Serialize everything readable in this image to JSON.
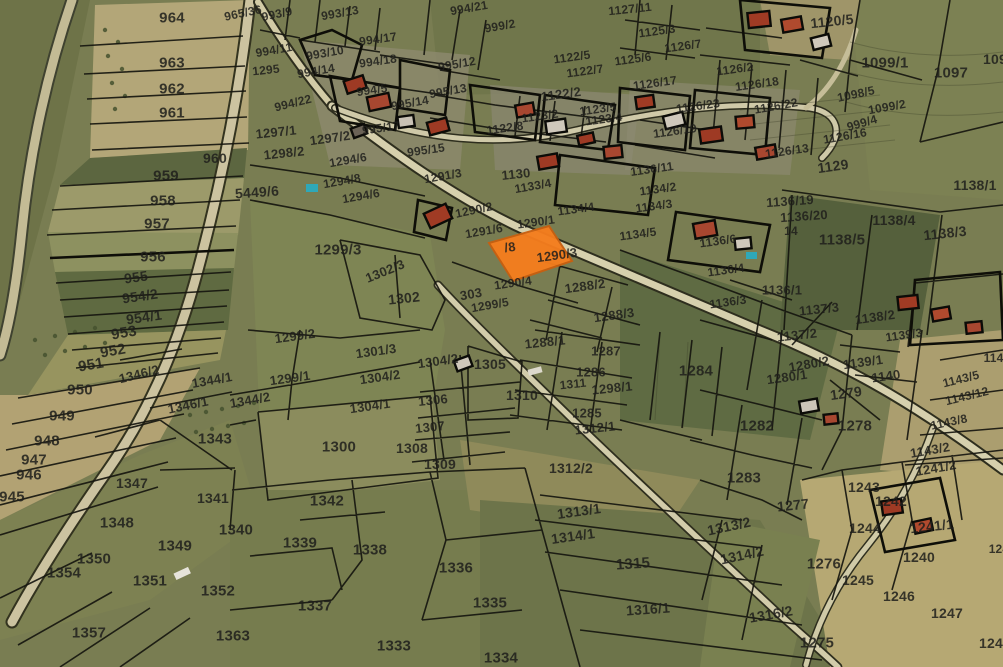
{
  "map": {
    "kind": "cadastral-parcel-map-over-aerial-imagery",
    "highlighted_parcel": {
      "visible_label": "/8",
      "overlapping_neighbor_label": "1290/3",
      "fill_color": "#f57d1d",
      "stroke_color": "#c85f10"
    },
    "colors": {
      "parcel_line": "#16160f",
      "label": "#1f1f1c",
      "road_fill": "#d2cba6",
      "field_green": "#797d52",
      "field_tan": "#b3a678"
    },
    "parcel_labels": [
      {
        "t": "964",
        "x": 172,
        "y": 18,
        "s": 15
      },
      {
        "t": "963",
        "x": 172,
        "y": 63,
        "s": 15
      },
      {
        "t": "962",
        "x": 172,
        "y": 89,
        "s": 15
      },
      {
        "t": "961",
        "x": 172,
        "y": 113,
        "s": 15
      },
      {
        "t": "960",
        "x": 215,
        "y": 158,
        "s": 14
      },
      {
        "t": "959",
        "x": 166,
        "y": 176,
        "s": 15
      },
      {
        "t": "958",
        "x": 163,
        "y": 201,
        "s": 15
      },
      {
        "t": "957",
        "x": 157,
        "y": 224,
        "s": 15
      },
      {
        "t": "956",
        "x": 153,
        "y": 257,
        "s": 15
      },
      {
        "t": "955",
        "x": 136,
        "y": 277,
        "s": 14,
        "r": -8
      },
      {
        "t": "954/2",
        "x": 140,
        "y": 296,
        "s": 14,
        "r": -8
      },
      {
        "t": "954/1",
        "x": 144,
        "y": 317,
        "s": 14,
        "r": -8
      },
      {
        "t": "953",
        "x": 124,
        "y": 333,
        "s": 15,
        "r": -10
      },
      {
        "t": "952",
        "x": 113,
        "y": 351,
        "s": 15,
        "r": -10
      },
      {
        "t": "951",
        "x": 91,
        "y": 365,
        "s": 15,
        "r": -10
      },
      {
        "t": "950",
        "x": 80,
        "y": 390,
        "s": 15
      },
      {
        "t": "949",
        "x": 62,
        "y": 416,
        "s": 15
      },
      {
        "t": "948",
        "x": 47,
        "y": 441,
        "s": 15
      },
      {
        "t": "947",
        "x": 34,
        "y": 460,
        "s": 15
      },
      {
        "t": "946",
        "x": 29,
        "y": 475,
        "s": 15
      },
      {
        "t": "945",
        "x": 12,
        "y": 497,
        "s": 15
      },
      {
        "t": "965/36",
        "x": 243,
        "y": 13,
        "s": 12,
        "r": -12
      },
      {
        "t": "5449/6",
        "x": 257,
        "y": 192,
        "s": 14,
        "r": -4
      },
      {
        "t": "993/9",
        "x": 277,
        "y": 14,
        "s": 12,
        "r": -12
      },
      {
        "t": "993/13",
        "x": 340,
        "y": 13,
        "s": 12,
        "r": -10
      },
      {
        "t": "994/21",
        "x": 469,
        "y": 8,
        "s": 12,
        "r": -10
      },
      {
        "t": "999/2",
        "x": 500,
        "y": 26,
        "s": 12,
        "r": -10
      },
      {
        "t": "994/17",
        "x": 378,
        "y": 39,
        "s": 12,
        "r": -8
      },
      {
        "t": "994/11",
        "x": 274,
        "y": 50,
        "s": 12,
        "r": -10
      },
      {
        "t": "993/10",
        "x": 325,
        "y": 53,
        "s": 12,
        "r": -10
      },
      {
        "t": "994/18",
        "x": 378,
        "y": 61,
        "s": 12,
        "r": -8
      },
      {
        "t": "995/12",
        "x": 457,
        "y": 64,
        "s": 12,
        "r": -10
      },
      {
        "t": "1295",
        "x": 266,
        "y": 70,
        "s": 12,
        "r": -6
      },
      {
        "t": "994/14",
        "x": 316,
        "y": 71,
        "s": 12,
        "r": -10
      },
      {
        "t": "994/5",
        "x": 372,
        "y": 90,
        "s": 12,
        "r": -8
      },
      {
        "t": "995/13",
        "x": 448,
        "y": 91,
        "s": 12,
        "r": -10
      },
      {
        "t": "995/14",
        "x": 410,
        "y": 103,
        "s": 12,
        "r": -10
      },
      {
        "t": "994/22",
        "x": 293,
        "y": 103,
        "s": 12,
        "r": -14
      },
      {
        "t": "995/17",
        "x": 381,
        "y": 128,
        "s": 12,
        "r": -8
      },
      {
        "t": "995/15",
        "x": 426,
        "y": 150,
        "s": 12,
        "r": -8
      },
      {
        "t": "1297/1",
        "x": 276,
        "y": 132,
        "s": 13,
        "r": -6
      },
      {
        "t": "1297/2",
        "x": 330,
        "y": 138,
        "s": 13,
        "r": -8
      },
      {
        "t": "1298/2",
        "x": 284,
        "y": 153,
        "s": 13,
        "r": -6
      },
      {
        "t": "1294/6",
        "x": 348,
        "y": 160,
        "s": 12,
        "r": -10
      },
      {
        "t": "1294/8",
        "x": 342,
        "y": 181,
        "s": 12,
        "r": -10
      },
      {
        "t": "1294/6",
        "x": 361,
        "y": 196,
        "s": 12,
        "r": -10
      },
      {
        "t": "1291/3",
        "x": 443,
        "y": 176,
        "s": 12,
        "r": -10
      },
      {
        "t": "1122/5",
        "x": 572,
        "y": 57,
        "s": 12,
        "r": -8
      },
      {
        "t": "1122/7",
        "x": 585,
        "y": 71,
        "s": 12,
        "r": -8
      },
      {
        "t": "1122/2",
        "x": 561,
        "y": 94,
        "s": 13,
        "r": -8
      },
      {
        "t": "1123/5",
        "x": 598,
        "y": 109,
        "s": 12,
        "r": -8
      },
      {
        "t": "1123/2",
        "x": 540,
        "y": 116,
        "s": 12,
        "r": -8
      },
      {
        "t": "1123/4",
        "x": 604,
        "y": 119,
        "s": 12,
        "r": -8
      },
      {
        "t": "1122/8",
        "x": 505,
        "y": 128,
        "s": 12,
        "r": -8
      },
      {
        "t": "1130",
        "x": 516,
        "y": 174,
        "s": 13,
        "r": -6
      },
      {
        "t": "1133/4",
        "x": 533,
        "y": 186,
        "s": 12,
        "r": -10
      },
      {
        "t": "1127/11",
        "x": 630,
        "y": 9,
        "s": 12,
        "r": -6
      },
      {
        "t": "1125/3",
        "x": 657,
        "y": 31,
        "s": 12,
        "r": -8
      },
      {
        "t": "1126/7",
        "x": 683,
        "y": 46,
        "s": 12,
        "r": -8
      },
      {
        "t": "1125/6",
        "x": 633,
        "y": 59,
        "s": 12,
        "r": -8
      },
      {
        "t": "1126/2",
        "x": 735,
        "y": 69,
        "s": 12,
        "r": -8
      },
      {
        "t": "1126/17",
        "x": 655,
        "y": 83,
        "s": 12,
        "r": -8
      },
      {
        "t": "1126/18",
        "x": 757,
        "y": 84,
        "s": 12,
        "r": -8
      },
      {
        "t": "1126/23",
        "x": 698,
        "y": 106,
        "s": 12,
        "r": -8
      },
      {
        "t": "1126/22",
        "x": 776,
        "y": 106,
        "s": 12,
        "r": -10
      },
      {
        "t": "1126/19",
        "x": 675,
        "y": 131,
        "s": 12,
        "r": -8
      },
      {
        "t": "1126/13",
        "x": 787,
        "y": 151,
        "s": 12,
        "r": -8
      },
      {
        "t": "1126/16",
        "x": 845,
        "y": 136,
        "s": 12,
        "r": -10
      },
      {
        "t": "999/4",
        "x": 862,
        "y": 123,
        "s": 12,
        "r": -16
      },
      {
        "t": "1098/5",
        "x": 856,
        "y": 94,
        "s": 12,
        "r": -12
      },
      {
        "t": "1099/2",
        "x": 887,
        "y": 107,
        "s": 12,
        "r": -10
      },
      {
        "t": "1120/5",
        "x": 832,
        "y": 21,
        "s": 14,
        "r": -6
      },
      {
        "t": "1099/1",
        "x": 885,
        "y": 63,
        "s": 15
      },
      {
        "t": "1097",
        "x": 951,
        "y": 73,
        "s": 15
      },
      {
        "t": "109",
        "x": 995,
        "y": 59,
        "s": 14
      },
      {
        "t": "1129",
        "x": 833,
        "y": 166,
        "s": 14,
        "r": -8
      },
      {
        "t": "1136/11",
        "x": 652,
        "y": 169,
        "s": 12,
        "r": -8
      },
      {
        "t": "1134/2",
        "x": 658,
        "y": 189,
        "s": 12,
        "r": -8
      },
      {
        "t": "1134/3",
        "x": 654,
        "y": 206,
        "s": 12,
        "r": -8
      },
      {
        "t": "1134/4",
        "x": 576,
        "y": 209,
        "s": 12,
        "r": -8
      },
      {
        "t": "1134/5",
        "x": 638,
        "y": 234,
        "s": 12,
        "r": -8
      },
      {
        "t": "1136/6",
        "x": 718,
        "y": 241,
        "s": 12,
        "r": -8
      },
      {
        "t": "1136/4",
        "x": 726,
        "y": 270,
        "s": 12,
        "r": -8
      },
      {
        "t": "1136/3",
        "x": 728,
        "y": 302,
        "s": 12,
        "r": -8
      },
      {
        "t": "1136/1",
        "x": 782,
        "y": 290,
        "s": 13
      },
      {
        "t": "1136/19",
        "x": 790,
        "y": 201,
        "s": 13,
        "r": -4
      },
      {
        "t": "1136/20",
        "x": 804,
        "y": 216,
        "s": 13,
        "r": -4
      },
      {
        "t": "14",
        "x": 791,
        "y": 231,
        "s": 12
      },
      {
        "t": "1137/3",
        "x": 819,
        "y": 309,
        "s": 13,
        "r": -6
      },
      {
        "t": "1137/2",
        "x": 797,
        "y": 335,
        "s": 13,
        "r": -6
      },
      {
        "t": "1138/2",
        "x": 875,
        "y": 317,
        "s": 13,
        "r": -8
      },
      {
        "t": "1139/3",
        "x": 904,
        "y": 335,
        "s": 12,
        "r": -8
      },
      {
        "t": "1139/1",
        "x": 863,
        "y": 362,
        "s": 13,
        "r": -8
      },
      {
        "t": "1140",
        "x": 886,
        "y": 376,
        "s": 13,
        "r": -8
      },
      {
        "t": "1143/5",
        "x": 961,
        "y": 379,
        "s": 12,
        "r": -14
      },
      {
        "t": "1143/12",
        "x": 967,
        "y": 396,
        "s": 12,
        "r": -14
      },
      {
        "t": "1143/8",
        "x": 949,
        "y": 422,
        "s": 12,
        "r": -12
      },
      {
        "t": "1143/2",
        "x": 930,
        "y": 450,
        "s": 13,
        "r": -10
      },
      {
        "t": "1241/2",
        "x": 936,
        "y": 468,
        "s": 13,
        "r": -10
      },
      {
        "t": "1142",
        "x": 997,
        "y": 358,
        "s": 12
      },
      {
        "t": "1138/1",
        "x": 975,
        "y": 185,
        "s": 14
      },
      {
        "t": "1138/4",
        "x": 894,
        "y": 220,
        "s": 14
      },
      {
        "t": "1138/3",
        "x": 945,
        "y": 233,
        "s": 14,
        "r": -6
      },
      {
        "t": "1138/5",
        "x": 842,
        "y": 240,
        "s": 15
      },
      {
        "t": "1290/2",
        "x": 474,
        "y": 210,
        "s": 12,
        "r": -12
      },
      {
        "t": "1291/6",
        "x": 484,
        "y": 231,
        "s": 12,
        "r": -10
      },
      {
        "t": "1290/1",
        "x": 536,
        "y": 222,
        "s": 12,
        "r": -8
      },
      {
        "t": "/8",
        "x": 510,
        "y": 247,
        "s": 13,
        "r": -8
      },
      {
        "t": "1290/3",
        "x": 557,
        "y": 255,
        "s": 13,
        "r": -8
      },
      {
        "t": "1290/4",
        "x": 513,
        "y": 283,
        "s": 12,
        "r": -8
      },
      {
        "t": "303",
        "x": 471,
        "y": 294,
        "s": 13,
        "r": -10
      },
      {
        "t": "1299/5",
        "x": 490,
        "y": 305,
        "s": 12,
        "r": -10
      },
      {
        "t": "1299/3",
        "x": 338,
        "y": 250,
        "s": 15
      },
      {
        "t": "1302/3",
        "x": 385,
        "y": 271,
        "s": 13,
        "r": -22
      },
      {
        "t": "1302",
        "x": 404,
        "y": 298,
        "s": 14,
        "r": -6
      },
      {
        "t": "1288/2",
        "x": 585,
        "y": 286,
        "s": 13,
        "r": -8
      },
      {
        "t": "1288/3",
        "x": 614,
        "y": 315,
        "s": 13,
        "r": -8
      },
      {
        "t": "1288/1",
        "x": 545,
        "y": 342,
        "s": 13,
        "r": -6
      },
      {
        "t": "1287",
        "x": 606,
        "y": 351,
        "s": 13
      },
      {
        "t": "1286",
        "x": 591,
        "y": 372,
        "s": 13
      },
      {
        "t": "1311",
        "x": 573,
        "y": 384,
        "s": 12,
        "r": -6
      },
      {
        "t": "1298/1",
        "x": 612,
        "y": 388,
        "s": 13,
        "r": -6
      },
      {
        "t": "1310",
        "x": 522,
        "y": 395,
        "s": 14
      },
      {
        "t": "1305",
        "x": 490,
        "y": 364,
        "s": 14
      },
      {
        "t": "1304/2",
        "x": 438,
        "y": 361,
        "s": 13,
        "r": -8
      },
      {
        "t": "1301/3",
        "x": 376,
        "y": 351,
        "s": 13,
        "r": -8
      },
      {
        "t": "1304/2",
        "x": 380,
        "y": 377,
        "s": 13,
        "r": -8
      },
      {
        "t": "1304/1",
        "x": 370,
        "y": 406,
        "s": 13,
        "r": -8
      },
      {
        "t": "1306",
        "x": 433,
        "y": 400,
        "s": 13,
        "r": -6
      },
      {
        "t": "1307",
        "x": 430,
        "y": 427,
        "s": 13,
        "r": -6
      },
      {
        "t": "1308",
        "x": 412,
        "y": 448,
        "s": 14
      },
      {
        "t": "1309",
        "x": 440,
        "y": 464,
        "s": 14
      },
      {
        "t": "1300",
        "x": 339,
        "y": 447,
        "s": 15
      },
      {
        "t": "1285",
        "x": 587,
        "y": 413,
        "s": 13
      },
      {
        "t": "1312/1",
        "x": 595,
        "y": 428,
        "s": 13,
        "r": -6
      },
      {
        "t": "1312/2",
        "x": 571,
        "y": 468,
        "s": 14
      },
      {
        "t": "1299/2",
        "x": 295,
        "y": 336,
        "s": 13,
        "r": -8
      },
      {
        "t": "1299/1",
        "x": 290,
        "y": 378,
        "s": 13,
        "r": -8
      },
      {
        "t": "1344/2",
        "x": 250,
        "y": 400,
        "s": 13,
        "r": -10
      },
      {
        "t": "1344/1",
        "x": 212,
        "y": 380,
        "s": 13,
        "r": -10
      },
      {
        "t": "1346/2",
        "x": 139,
        "y": 374,
        "s": 13,
        "r": -14
      },
      {
        "t": "1346/1",
        "x": 188,
        "y": 405,
        "s": 13,
        "r": -12
      },
      {
        "t": "1343",
        "x": 215,
        "y": 439,
        "s": 15
      },
      {
        "t": "1347",
        "x": 132,
        "y": 483,
        "s": 14
      },
      {
        "t": "1341",
        "x": 213,
        "y": 498,
        "s": 14
      },
      {
        "t": "1348",
        "x": 117,
        "y": 523,
        "s": 15
      },
      {
        "t": "1349",
        "x": 175,
        "y": 546,
        "s": 15
      },
      {
        "t": "1340",
        "x": 236,
        "y": 530,
        "s": 15
      },
      {
        "t": "1350",
        "x": 94,
        "y": 559,
        "s": 15
      },
      {
        "t": "1354",
        "x": 64,
        "y": 573,
        "s": 15
      },
      {
        "t": "1351",
        "x": 150,
        "y": 581,
        "s": 15
      },
      {
        "t": "1352",
        "x": 218,
        "y": 591,
        "s": 15
      },
      {
        "t": "1357",
        "x": 89,
        "y": 633,
        "s": 15
      },
      {
        "t": "1363",
        "x": 233,
        "y": 636,
        "s": 15
      },
      {
        "t": "1342",
        "x": 327,
        "y": 501,
        "s": 15
      },
      {
        "t": "1339",
        "x": 300,
        "y": 543,
        "s": 15
      },
      {
        "t": "1338",
        "x": 370,
        "y": 550,
        "s": 15
      },
      {
        "t": "1336",
        "x": 456,
        "y": 568,
        "s": 15
      },
      {
        "t": "1337",
        "x": 315,
        "y": 606,
        "s": 15
      },
      {
        "t": "1335",
        "x": 490,
        "y": 603,
        "s": 15
      },
      {
        "t": "1333",
        "x": 394,
        "y": 646,
        "s": 15
      },
      {
        "t": "1334",
        "x": 501,
        "y": 658,
        "s": 15
      },
      {
        "t": "1313/1",
        "x": 579,
        "y": 511,
        "s": 14,
        "r": -8
      },
      {
        "t": "1314/1",
        "x": 573,
        "y": 536,
        "s": 14,
        "r": -8
      },
      {
        "t": "1315",
        "x": 633,
        "y": 564,
        "s": 15,
        "r": -4
      },
      {
        "t": "1316/1",
        "x": 648,
        "y": 609,
        "s": 14,
        "r": -4
      },
      {
        "t": "1313/2",
        "x": 729,
        "y": 526,
        "s": 14,
        "r": -12
      },
      {
        "t": "1314/2",
        "x": 742,
        "y": 555,
        "s": 14,
        "r": -12
      },
      {
        "t": "1316/2",
        "x": 771,
        "y": 614,
        "s": 14,
        "r": -10
      },
      {
        "t": "1284",
        "x": 696,
        "y": 371,
        "s": 15
      },
      {
        "t": "1280/2",
        "x": 809,
        "y": 364,
        "s": 13,
        "r": -10
      },
      {
        "t": "1280/1",
        "x": 787,
        "y": 377,
        "s": 13,
        "r": -8
      },
      {
        "t": "1279",
        "x": 846,
        "y": 393,
        "s": 14,
        "r": -8
      },
      {
        "t": "1278",
        "x": 855,
        "y": 426,
        "s": 15
      },
      {
        "t": "1282",
        "x": 757,
        "y": 426,
        "s": 15
      },
      {
        "t": "1283",
        "x": 744,
        "y": 478,
        "s": 15
      },
      {
        "t": "1277",
        "x": 793,
        "y": 505,
        "s": 14,
        "r": -6
      },
      {
        "t": "1275",
        "x": 817,
        "y": 643,
        "s": 15
      },
      {
        "t": "1276",
        "x": 824,
        "y": 564,
        "s": 15
      },
      {
        "t": "1243",
        "x": 864,
        "y": 487,
        "s": 14
      },
      {
        "t": "1242",
        "x": 891,
        "y": 501,
        "s": 14
      },
      {
        "t": "1244",
        "x": 865,
        "y": 528,
        "s": 14
      },
      {
        "t": "1241/1",
        "x": 932,
        "y": 526,
        "s": 14,
        "r": -6
      },
      {
        "t": "1240",
        "x": 919,
        "y": 557,
        "s": 14
      },
      {
        "t": "1245",
        "x": 858,
        "y": 580,
        "s": 14
      },
      {
        "t": "1246",
        "x": 899,
        "y": 596,
        "s": 14
      },
      {
        "t": "1247",
        "x": 947,
        "y": 613,
        "s": 14
      },
      {
        "t": "1246",
        "x": 995,
        "y": 643,
        "s": 14
      },
      {
        "t": "124",
        "x": 999,
        "y": 549,
        "s": 12
      }
    ]
  }
}
